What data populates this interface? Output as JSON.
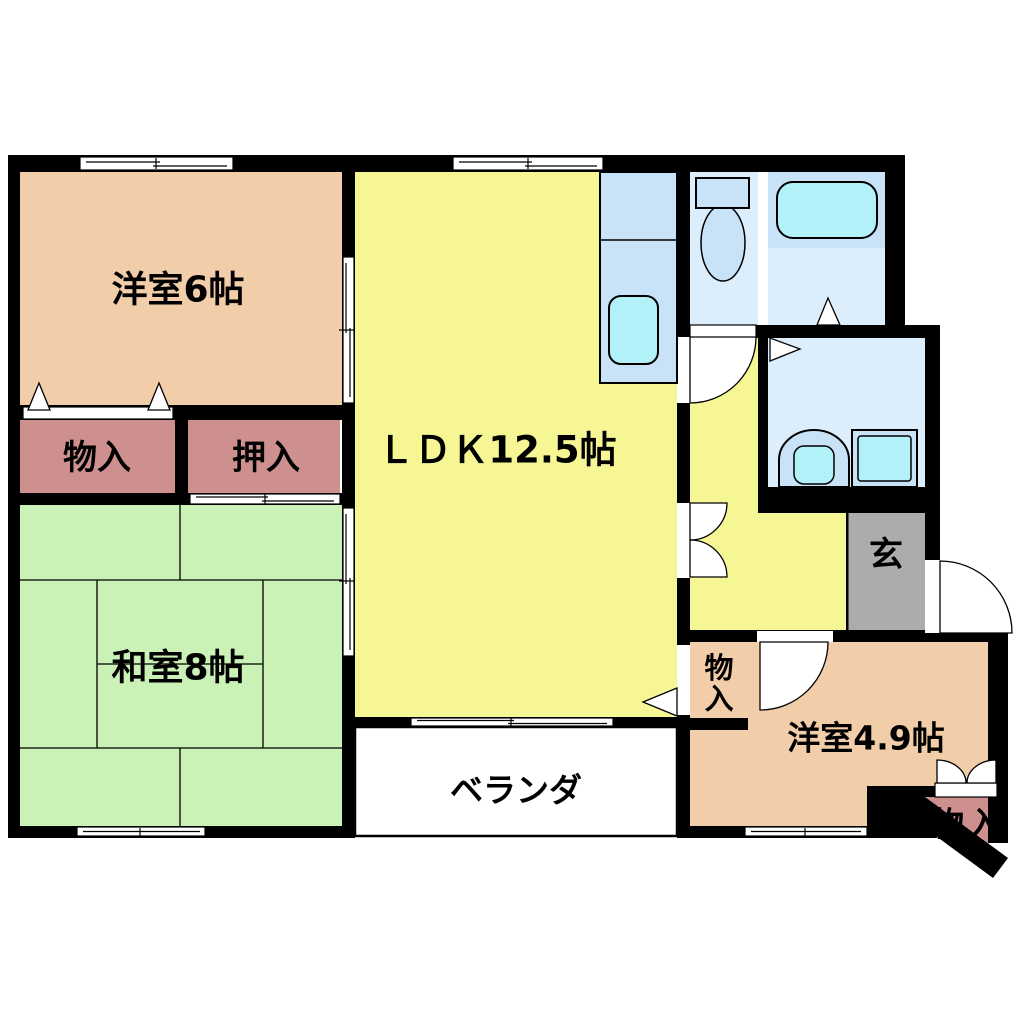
{
  "rooms": {
    "western6": {
      "label": "洋室6帖"
    },
    "ldk": {
      "label": "ＬＤＫ12.5帖"
    },
    "japanese8": {
      "label": "和室8帖"
    },
    "western49": {
      "label": "洋室4.9帖"
    },
    "veranda": {
      "label": "ベランダ"
    },
    "entrance": {
      "label": "玄"
    }
  },
  "closets": {
    "storage_north": {
      "label": "物入"
    },
    "oshiire": {
      "label": "押入"
    },
    "storage_hall_chars": [
      "物",
      "入"
    ],
    "storage_corner": {
      "label": "物入"
    }
  },
  "colors": {
    "wall": "#000000",
    "western_room_fill": "#F2CDA9",
    "closet_fill": "#CE8F8F",
    "japanese_room_fill": "#CBF2B6",
    "ldk_fill": "#F7F694",
    "entrance_fill": "#ACACAC",
    "wet_floor_light": "#DCEEFB",
    "wet_floor_mid": "#C8E2F8",
    "fixture_cyan": "#B2F1F8",
    "veranda_fill": "#FFFFFF"
  }
}
